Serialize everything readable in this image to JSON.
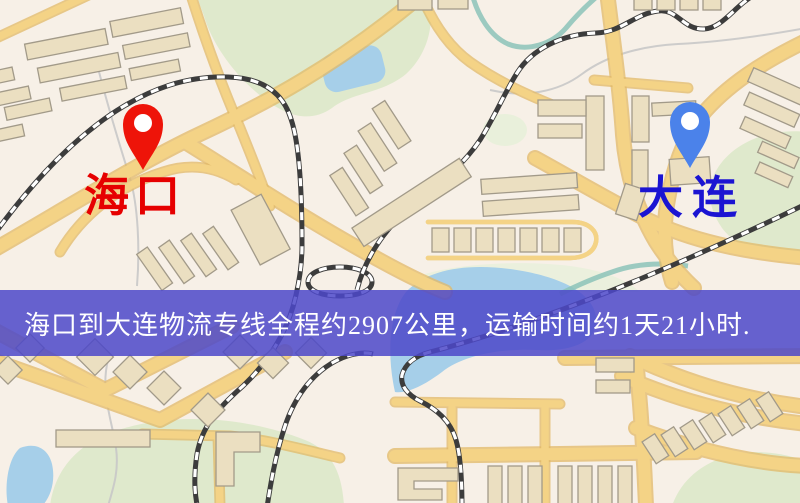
{
  "banner": {
    "text": "海口到大连物流专线全程约2907公里，运输时间约1天21小时.",
    "background": "#4C48C9D9"
  },
  "route": {
    "origin": "海口",
    "destination": "大连",
    "distance_text": "约2907公里",
    "duration_text": "约1天21小时"
  },
  "markers": {
    "origin": {
      "label": "海口",
      "pin_color": "#EE1409",
      "label_color": "#E60000"
    },
    "destination": {
      "label": "大连",
      "pin_color": "#4B82EA",
      "label_color": "#1B14D2"
    }
  },
  "map_palette": {
    "background": "#F7F0E7",
    "road": "#F4D386",
    "road_casing": "#E2B967",
    "building": "#EBDFC1",
    "building_outline": "#A29A89",
    "green": "#DFE9CC",
    "water": "#A6CFE9",
    "railway": "#3C3C3C"
  }
}
